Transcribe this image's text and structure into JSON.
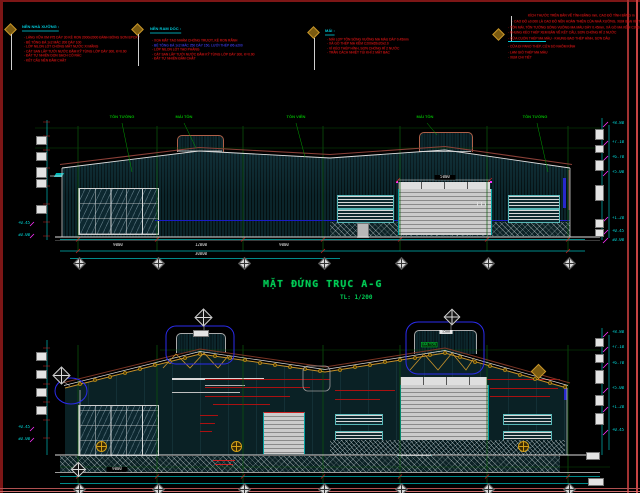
{
  "colors": {
    "grid_green": "#0a5a0a",
    "dim_cyan": "#00c8c8",
    "note_red": "#c41414",
    "heading_cyan": "#00c8d8",
    "title_green": "#00cc55",
    "truss_gold": "#c8922a",
    "callout_blue": "#2b2bee",
    "roof_brown": "#8b4038"
  },
  "notes": [
    {
      "heading": "NỀN NHÀ XƯỞNG :",
      "items": [
        "- LÁNG VỮA XM #75 DÀY 30 KẺ RON 2000x2000 ĐÁNH BÓNG SƠN EPOXY",
        "- BÊ TÔNG ĐÁ 1x2 MÁC 200 DÀY 100",
        "- LỚP NILON LÓT CHỐNG MẤT NƯỚC XI MĂNG",
        "- CÁT SAN LẤP TƯỚI NƯỚC ĐẦM KỸ TỪNG LỚP DÀY 300, K=0.90",
        "- ĐẤT TỰ NHIÊN DỌN SẠCH CỎ RÁC",
        "- KẾT CẤU NỀN ĐẦM CHẶT"
      ]
    },
    {
      "heading": "NỀN RAM DỐC :",
      "items": [
        "- XOA MẶT TẠO NHÁM CHỐNG TRƯỢT, KẺ RON RÃNH",
        "- BÊ TÔNG ĐÁ 1x2 MÁC 250 DÀY 150, LƯỚI THÉP Ø6 a200",
        "- LỚP NILON LÓT TẠO PHẲNG",
        "- CÁT SAN LẤP TƯỚI NƯỚC ĐẦM KỸ TỪNG LỚP DÀY 300, K=0.90",
        "- ĐẤT TỰ NHIÊN ĐẦM CHẶT"
      ]
    },
    {
      "heading": "MÁI :",
      "items": [
        "- MÁI LỢP TÔN SÓNG VUÔNG MẠ MÀU DÀY 0.45mm",
        "- XÀ GỒ THÉP MẠ KẼM C200x65x20x2.0",
        "- VÌ KÈO THÉP HÌNH, SƠN CHỐNG RỈ 2 NƯỚC",
        "- TRẦN CÁCH NHIỆT TÚI KHÍ 2 MẶT BẠC"
      ]
    }
  ],
  "general_notes": {
    "items": [
      "KÍCH THƯỚC TRÊN BẢN VẼ TÍNH BẰNG mm, CAO ĐỘ TÍNH BẰNG m",
      "- CAO ĐỘ ±0.000 LÀ CAO ĐỘ NỀN HOÀN THIỆN CỦA NHÀ XƯỞNG, XEM BẢN VẼ TMB",
      "- TÔN MÁI, TÔN TƯỜNG SÓNG VUÔNG MẠ MÀU DÀY 0.45mm, XÀ GỒ MẠ KẼM C200x65x20x2.0",
      "- KHUNG KÈO THÉP XEM BẢN VẼ KẾT CẤU, SƠN CHỐNG RỈ 2 NƯỚC",
      "- CỬA CUỐN THÉP MẠ MÀU - KHUNG BAO THÉP HÌNH, SƠN DẦU",
      "- CỬA ĐI PANO THÉP, CỬA SỔ NHÔM KÍNH",
      "- LAM GIÓ THÉP MẠ MÀU",
      "- XEM CHI TIẾT"
    ]
  },
  "elevation": {
    "title": "MẶT ĐỨNG TRỤC A-G",
    "scale": "TL: 1/200",
    "material_labels": [
      "TÔN TƯỜNG",
      "MÁI TÔN",
      "TÔN VIỀN",
      "MÁI TÔN",
      "TÔN TƯỜNG"
    ],
    "span_dims": [
      "9000",
      "12000",
      "9000"
    ],
    "total_dim": "30000",
    "door_dim": "5000",
    "left_levels": [
      "+0.45",
      "±0.00"
    ],
    "right_levels": [
      "+8.80",
      "+7.10",
      "+6.70",
      "+5.00",
      "+1.20",
      "+0.45",
      "±0.00"
    ]
  },
  "section": {
    "monitor_label": "MÁI TÔN",
    "monitor_dim": "1500",
    "span_dim": "9000",
    "left_levels": [
      "+0.45",
      "±0.00"
    ],
    "right_levels": [
      "+8.80",
      "+7.10",
      "+6.70",
      "+5.00",
      "+1.20",
      "+0.45"
    ]
  }
}
